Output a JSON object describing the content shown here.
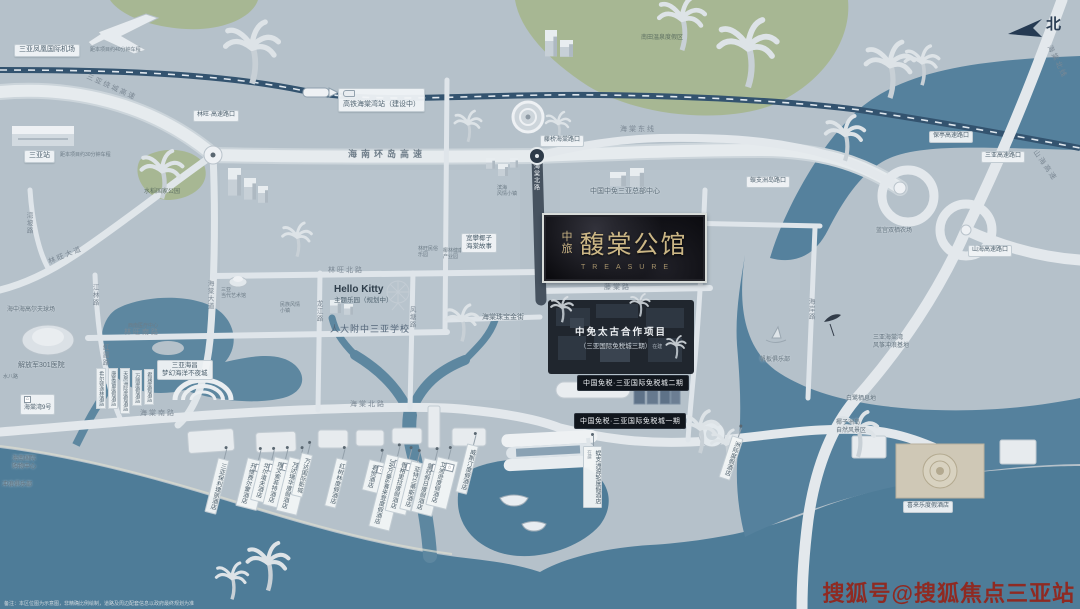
{
  "meta": {
    "region": "三亚海棠湾区位示意图",
    "north_label": "北",
    "colors": {
      "land": "#b5c1ca",
      "water": "#4e7d99",
      "green": "#a7b793",
      "gold": "#c9b384",
      "site_dark": "#20262e",
      "watermark_red": "#8f2a22"
    }
  },
  "project": {
    "brand": "中旅",
    "name": "馥棠公馆",
    "english": "TREASURE"
  },
  "site": {
    "line1": "中免太古合作项目",
    "line2": "（三亚国际免税城三期）",
    "tag": "在建"
  },
  "duty_free": {
    "phase2_label": "中国免税·三亚国际免税城二期",
    "phase1_label": "中国免税·三亚国际免税城一期"
  },
  "watermark": {
    "text": "搜狐号@搜狐焦点三亚站"
  },
  "disclaimer": "备注：本区位图为示意图，非精确比例绘制，道路及周边配套信息以政府最终规划为准",
  "map_labels": [
    {
      "n": "airport-label",
      "t": "三亚凤凰国际机场",
      "x": 14,
      "y": 44,
      "s": "pill"
    },
    {
      "n": "airport-distance",
      "t": "距本项目约40分钟车程",
      "x": 90,
      "y": 47,
      "s": "plain-xs"
    },
    {
      "n": "station-label",
      "t": "三亚站",
      "x": 24,
      "y": 150,
      "s": "pill"
    },
    {
      "n": "station-distance",
      "t": "距本项目约30分钟车程",
      "x": 60,
      "y": 152,
      "s": "plain-xs"
    },
    {
      "n": "hsr-station-label",
      "t": "高铁海棠湾站（建设中）",
      "x": 338,
      "y": 88,
      "s": "pill",
      "i": "train"
    },
    {
      "n": "linwang-exit-label",
      "t": "林旺·高速路口",
      "x": 193,
      "y": 110,
      "s": "pill-sm"
    },
    {
      "n": "tengqiao-exit-label",
      "t": "藤桥海棠路口",
      "x": 540,
      "y": 135,
      "s": "pill-sm"
    },
    {
      "n": "wuzhizhou-exit-label",
      "t": "蜈支洲岛路口",
      "x": 746,
      "y": 176,
      "s": "pill-sm"
    },
    {
      "n": "baoting-exit-label",
      "t": "保亭高速路口",
      "x": 929,
      "y": 131,
      "s": "pill-sm"
    },
    {
      "n": "sanya-exit-label",
      "t": "三亚高速路口",
      "x": 981,
      "y": 151,
      "s": "pill-sm"
    },
    {
      "n": "shanhai-exit-label",
      "t": "山海高速路口",
      "x": 968,
      "y": 245,
      "s": "pill-sm"
    },
    {
      "n": "raocheng-expressway-label",
      "t": "三亚绕城高速",
      "x": 84,
      "y": 84,
      "s": "road",
      "r": 24
    },
    {
      "n": "huandao-expressway-label",
      "t": "海南环岛高速",
      "x": 348,
      "y": 149,
      "s": "road-lg"
    },
    {
      "n": "haitang-east-line-label",
      "t": "海棠东线",
      "x": 620,
      "y": 126,
      "s": "road"
    },
    {
      "n": "haitang-north-line-label",
      "t": "海棠北线",
      "x": 1038,
      "y": 58,
      "s": "road",
      "r": 64
    },
    {
      "n": "shanhai-expressway-label",
      "t": "山海高速",
      "x": 1026,
      "y": 162,
      "s": "road",
      "r": 55
    },
    {
      "n": "linwang-avenue-label",
      "t": "林旺大道",
      "x": 48,
      "y": 252,
      "s": "road",
      "r": -22
    },
    {
      "n": "wanpo-road-label",
      "t": "湾坡路",
      "x": 24,
      "y": 212,
      "s": "road-v"
    },
    {
      "n": "jianglin-road-label",
      "t": "江林路",
      "x": 90,
      "y": 284,
      "s": "road-v"
    },
    {
      "n": "hongxia-road-label",
      "t": "红霞路",
      "x": 100,
      "y": 344,
      "s": "road-v"
    },
    {
      "n": "shuiba-road-label",
      "t": "水八路",
      "x": 3,
      "y": 374,
      "s": "plain-xs"
    },
    {
      "n": "haitang-avenue-label",
      "t": "海棠大道",
      "x": 205,
      "y": 280,
      "s": "road-v"
    },
    {
      "n": "linwang-north-road-label",
      "t": "林旺北路",
      "x": 328,
      "y": 267,
      "s": "road"
    },
    {
      "n": "linwang-south-road-label",
      "t": "林旺南路",
      "x": 124,
      "y": 329,
      "s": "road"
    },
    {
      "n": "haitang-south-road-label",
      "t": "海棠南路",
      "x": 140,
      "y": 410,
      "s": "road"
    },
    {
      "n": "longjiang-road-label",
      "t": "龙江路",
      "x": 314,
      "y": 300,
      "s": "road-v"
    },
    {
      "n": "fengtang-road-label",
      "t": "风塘路",
      "x": 407,
      "y": 306,
      "s": "road-v"
    },
    {
      "n": "haitang-north-road-label",
      "t": "海棠北路",
      "x": 350,
      "y": 401,
      "s": "road"
    },
    {
      "n": "tengtang-road-label",
      "t": "藤棠路",
      "x": 604,
      "y": 284,
      "s": "road"
    },
    {
      "n": "haitang-north-road-dark-label",
      "t": "海棠北路",
      "x": 531,
      "y": 163,
      "s": "road-vd"
    },
    {
      "n": "haian-road-label",
      "t": "海岸路",
      "x": 806,
      "y": 298,
      "s": "road-v"
    },
    {
      "n": "hellokitty-label",
      "lines": [
        "Hello Kitty",
        "主题乐园（规划中）"
      ],
      "x": 334,
      "y": 284,
      "s": "hk"
    },
    {
      "n": "school-label",
      "t": "人大附中三亚学校",
      "x": 330,
      "y": 324,
      "s": "plain-lg"
    },
    {
      "n": "haichang-label",
      "lines": [
        "三亚海昌",
        "梦幻海洋不夜城"
      ],
      "x": 157,
      "y": 360,
      "s": "pill-2l"
    },
    {
      "n": "rice-park-label",
      "t": "水稻国家公园",
      "x": 144,
      "y": 189,
      "s": "plain-g"
    },
    {
      "n": "hospital-label",
      "t": "解放军301医院",
      "x": 18,
      "y": 362,
      "s": "plain"
    },
    {
      "n": "haitangwan9-label",
      "t": "海棠湾9号",
      "x": 20,
      "y": 394,
      "s": "pill-sm",
      "i": "h"
    },
    {
      "n": "golf-label",
      "t": "海中海高尔夫球场",
      "x": 7,
      "y": 307,
      "s": "plain-sm"
    },
    {
      "n": "intl-shopping-label",
      "lines": [
        "海南国际",
        "购物中心"
      ],
      "x": 12,
      "y": 456,
      "s": "plain-sm"
    },
    {
      "n": "surf-club-label",
      "t": "冲浪俱乐部",
      "x": 2,
      "y": 482,
      "s": "plain-sm"
    },
    {
      "n": "medical-center-label",
      "t": "西南医疗中心",
      "x": 128,
      "y": 323,
      "s": "plain-xs"
    },
    {
      "n": "art-museum-label",
      "lines": [
        "三亚",
        "当代艺术馆"
      ],
      "x": 221,
      "y": 287,
      "s": "plain-xs"
    },
    {
      "n": "minzu-town-label",
      "lines": [
        "民族风情",
        "小镇"
      ],
      "x": 280,
      "y": 302,
      "s": "plain-xs"
    },
    {
      "n": "folk-park-label",
      "lines": [
        "林旺民俗",
        "乐园"
      ],
      "x": 418,
      "y": 246,
      "s": "plain-xs"
    },
    {
      "n": "yelin-park-label",
      "lines": [
        "椰林健康",
        "产业园"
      ],
      "x": 443,
      "y": 248,
      "s": "plain-xs"
    },
    {
      "n": "coconut-story-label",
      "lines": [
        "宽攀椰子",
        "海棠故事"
      ],
      "x": 461,
      "y": 233,
      "s": "pill-2l"
    },
    {
      "n": "jewelry-street-label",
      "t": "海棠珠宝金街",
      "x": 482,
      "y": 314,
      "s": "plain"
    },
    {
      "n": "binhai-town-label",
      "lines": [
        "滨海",
        "风情小镇"
      ],
      "x": 497,
      "y": 185,
      "s": "plain-xs"
    },
    {
      "n": "cdf-hq-label",
      "t": "中国中免三亚总部中心",
      "x": 590,
      "y": 188,
      "s": "plain"
    },
    {
      "n": "nantian-springs-label",
      "t": "南田温泉度假区",
      "x": 641,
      "y": 35,
      "s": "plain-g"
    },
    {
      "n": "windsurf-club-label",
      "t": "帆板俱乐部",
      "x": 760,
      "y": 357,
      "s": "plain-sm"
    },
    {
      "n": "kite-base-label",
      "lines": [
        "三亚海棠湾",
        "风筝冲浪基地"
      ],
      "x": 873,
      "y": 335,
      "s": "plain-sm"
    },
    {
      "n": "egret-habitat-label",
      "t": "白鹭栖息地",
      "x": 846,
      "y": 396,
      "s": "plain-sm"
    },
    {
      "n": "farm-label",
      "t": "蓝宫双栖农场",
      "x": 876,
      "y": 228,
      "s": "plain-sm"
    },
    {
      "n": "coconut-isle-label",
      "lines": [
        "椰子洲岛",
        "自然风景区"
      ],
      "x": 836,
      "y": 420,
      "s": "plain-sm"
    },
    {
      "n": "hotel-hilton-doubletree",
      "t": "希尔顿逸林酒店",
      "x": 96,
      "y": 368,
      "s": "vert-sm"
    },
    {
      "n": "hotel-conrad",
      "t": "康莱德度假酒店",
      "x": 108,
      "y": 368,
      "s": "vert-sm"
    },
    {
      "n": "hotel-intercontinental-west",
      "t": "天房洲际度假酒店",
      "x": 120,
      "y": 368,
      "s": "vert-sm"
    },
    {
      "n": "hotel-renaissance",
      "t": "万丽度假酒店",
      "x": 132,
      "y": 370,
      "s": "vert-sm"
    },
    {
      "n": "hotel-junlan",
      "t": "君澜度假酒店",
      "x": 144,
      "y": 369,
      "s": "vert-sm"
    },
    {
      "n": "hotel-rosewood",
      "t": "三亚保利瑰丽酒店",
      "x": 211,
      "y": 458,
      "s": "vert",
      "r": 14
    },
    {
      "n": "hotel-fairmont",
      "t": "开维费尔蒙酒店",
      "x": 241,
      "y": 459,
      "s": "vert",
      "r": 14,
      "i": "h"
    },
    {
      "n": "hotel-waldorf",
      "t": "华尔道夫酒店",
      "x": 255,
      "y": 459,
      "s": "vert",
      "r": 14,
      "i": "h"
    },
    {
      "n": "hotel-sofitel",
      "t": "理文索菲特酒店",
      "x": 268,
      "y": 458,
      "s": "vert",
      "r": 14,
      "i": "h"
    },
    {
      "n": "hotel-wanda-reign",
      "t": "万达瑞华度假酒店",
      "x": 282,
      "y": 458,
      "s": "vert",
      "r": 14,
      "i": "h"
    },
    {
      "n": "wanda-cinema-label",
      "t": "万达国际影城",
      "x": 296,
      "y": 453,
      "s": "vert",
      "r": 14
    },
    {
      "n": "hotel-mangrove",
      "t": "红树林度假酒店",
      "x": 330,
      "y": 458,
      "s": "vert",
      "r": 14
    },
    {
      "n": "hotel-grand-hyatt",
      "t": "君悦酒店",
      "x": 365,
      "y": 461,
      "s": "vert",
      "r": 14,
      "i": "h"
    },
    {
      "n": "hotel-jw-marriott",
      "t": "JW万豪&喜来登度假酒店",
      "x": 377,
      "y": 455,
      "s": "vert",
      "r": 14,
      "i": "h"
    },
    {
      "n": "hotel-shangrila",
      "t": "香格里拉度假酒店",
      "x": 391,
      "y": 458,
      "s": "vert",
      "r": 14,
      "i": "h"
    },
    {
      "n": "hotel-atlantis",
      "t": "亚特兰蒂斯酒店",
      "x": 405,
      "y": 461,
      "s": "vert",
      "r": 14
    },
    {
      "n": "hotel-crowne-plaza",
      "t": "皇冠假日度假酒店",
      "x": 417,
      "y": 459,
      "s": "vert",
      "r": 14,
      "i": "h"
    },
    {
      "n": "hotel-edition",
      "t": "艾迪逊度假酒店",
      "x": 431,
      "y": 458,
      "s": "vert",
      "r": 14,
      "i": "h"
    },
    {
      "n": "hotel-westin",
      "t": "威斯汀度假酒店",
      "x": 461,
      "y": 444,
      "s": "vert",
      "r": 14
    },
    {
      "n": "wuzhizhou-ferry-hotel-label",
      "t": "蜈支洲渡轮度假酒店",
      "x": 583,
      "y": 446,
      "s": "vert",
      "suf": "在建"
    },
    {
      "n": "hotel-intercontinental",
      "t": "洲际度假酒店",
      "x": 725,
      "y": 436,
      "s": "vert",
      "r": 18
    },
    {
      "n": "hotel-xilaile",
      "t": "喜来乐度假酒店",
      "x": 903,
      "y": 501,
      "s": "pill-sm"
    },
    {
      "n": "north-label",
      "t": "北",
      "x": 1046,
      "y": 16,
      "s": "north"
    }
  ]
}
